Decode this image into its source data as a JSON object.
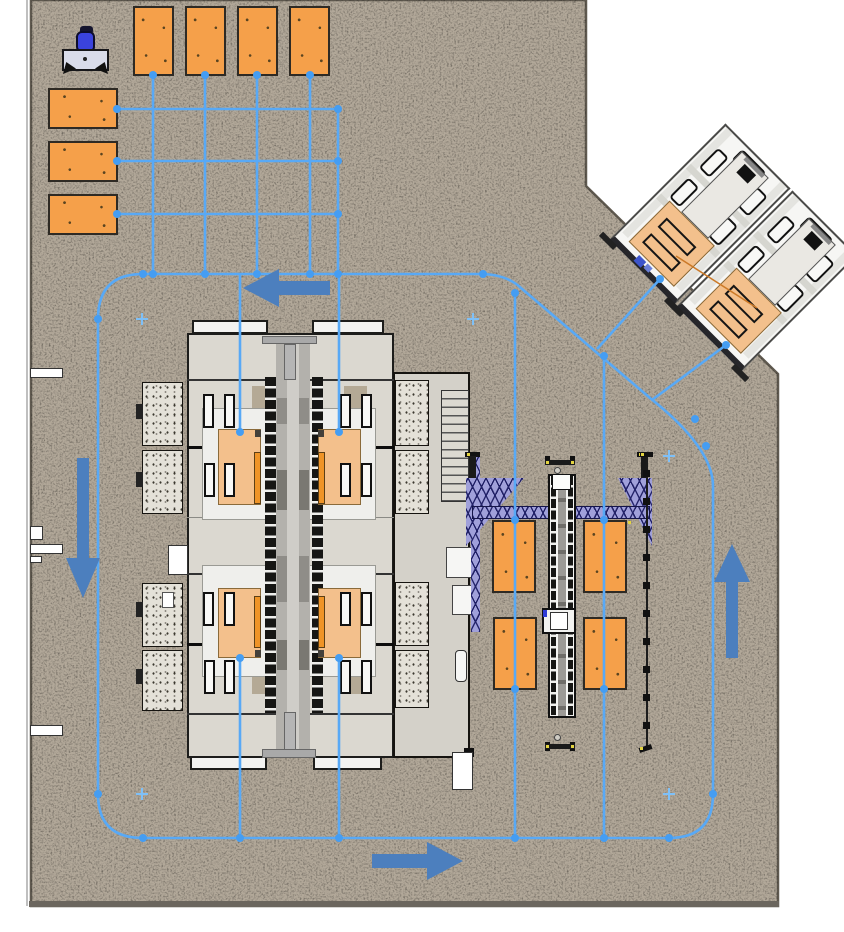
{
  "meta": {
    "title": "Automated production cell floor plan",
    "description": "Top-down CAD layout of a machining cell with AGV guide-path network",
    "canvas": {
      "width": 844,
      "height": 932
    }
  },
  "colors": {
    "floor": "#b2a899",
    "floor_edge": "#5f594f",
    "wall_strip": "#6b665e",
    "pallet_orange": "#f5a04a",
    "machine_pallet_orange": "#f3c08c",
    "path_blue": "#58a9f6",
    "node_blue": "#459df2",
    "arrow_blue": "#4c7fbe",
    "truss_purple": "#a0a0da",
    "truss_dark": "#222268",
    "agv_drum_blue": "#3a43dd",
    "machine_gray": "#dbd8d0",
    "accent_orange_line": "#cc7a28"
  },
  "agv": {
    "label": "AGV carrying blue drum load"
  },
  "pallet_groups": {
    "top_row": {
      "label": "Pallet staging row (top)",
      "count": 4
    },
    "left_column": {
      "label": "Pallet staging column (left)",
      "count": 3
    },
    "gantry_cell": {
      "label": "Pallet stands at gantry cell",
      "count": 4
    },
    "machine_internal": {
      "label": "Pallets inside processing center",
      "count": 4
    },
    "angled_machines": {
      "label": "Pallets on angled machines",
      "count": 2
    }
  },
  "machines": {
    "processing_center": {
      "label": "Central processing / machining center"
    },
    "gantry": {
      "label": "Gantry loader with lattice truss and rail"
    },
    "angled_machine_1": {
      "label": "Angled machine tool 1"
    },
    "angled_machine_2": {
      "label": "Angled machine tool 2"
    },
    "fence": {
      "label": "Safety fence line"
    }
  },
  "paths": {
    "label": "AGV guide path network",
    "node_count": 40,
    "plus_marker_count": 5,
    "arrows": [
      {
        "name": "flow-arrow-left",
        "direction": "left"
      },
      {
        "name": "flow-arrow-down",
        "direction": "down"
      },
      {
        "name": "flow-arrow-right",
        "direction": "right"
      },
      {
        "name": "flow-arrow-up",
        "direction": "up"
      }
    ]
  }
}
